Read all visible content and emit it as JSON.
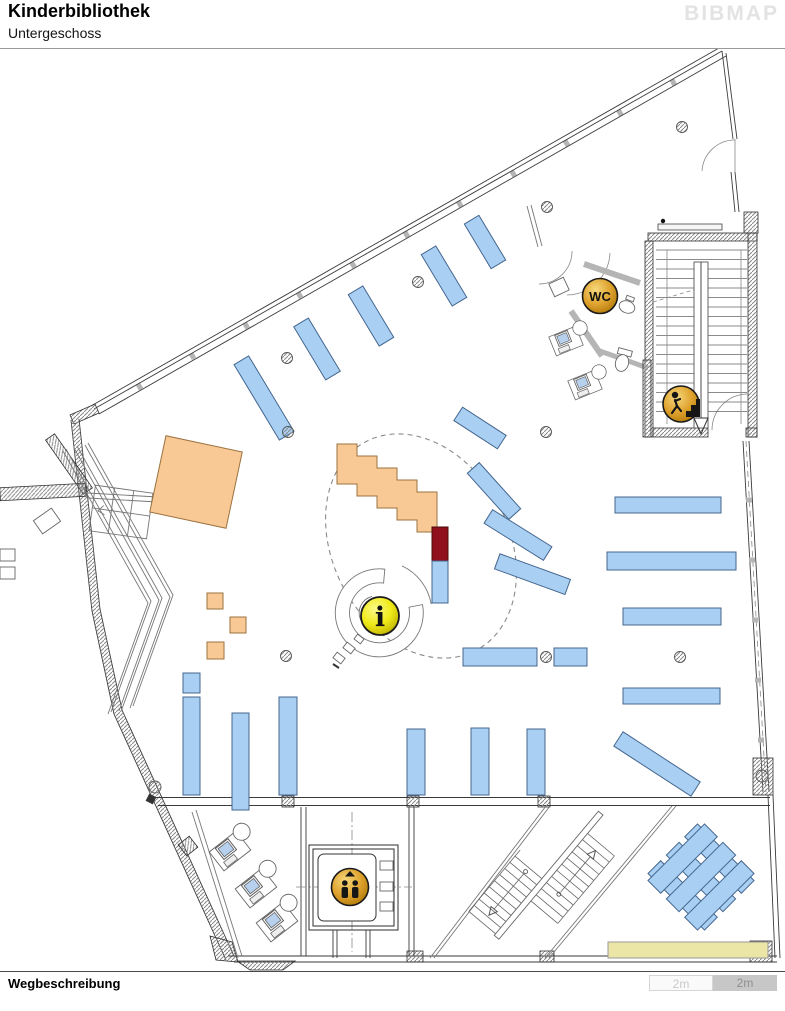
{
  "header": {
    "title": "Kinderbibliothek",
    "subtitle": "Untergeschoss",
    "brand": "BIBMAP"
  },
  "map": {
    "floor": "Untergeschoss",
    "markers": [
      {
        "id": "wc",
        "label": "WC",
        "transform": "translate(600,296)"
      },
      {
        "id": "stairs-up",
        "label": "",
        "transform": "translate(681,404)"
      },
      {
        "id": "info",
        "label": "i",
        "transform": "translate(380,616)"
      },
      {
        "id": "elevator",
        "label": "",
        "transform": "translate(350,887)"
      }
    ],
    "colors": {
      "shelf": "#a9cff2",
      "shelf_stroke": "#44668f",
      "furniture": "#f8c994",
      "furniture_stroke": "#9c7240",
      "accent": "#8f0f1c",
      "bench": "#ece6a6",
      "gold_light": "#f6d87c",
      "gold": "#dfa32f",
      "gold_dark": "#b27908",
      "yellow_light": "#fbfa8a",
      "yellow": "#f0ea18",
      "yellow_dark": "#bdb000"
    }
  },
  "footer": {
    "wegbeschreibung_label": "Wegbeschreibung",
    "scale_left": "2m",
    "scale_right": "2m"
  }
}
